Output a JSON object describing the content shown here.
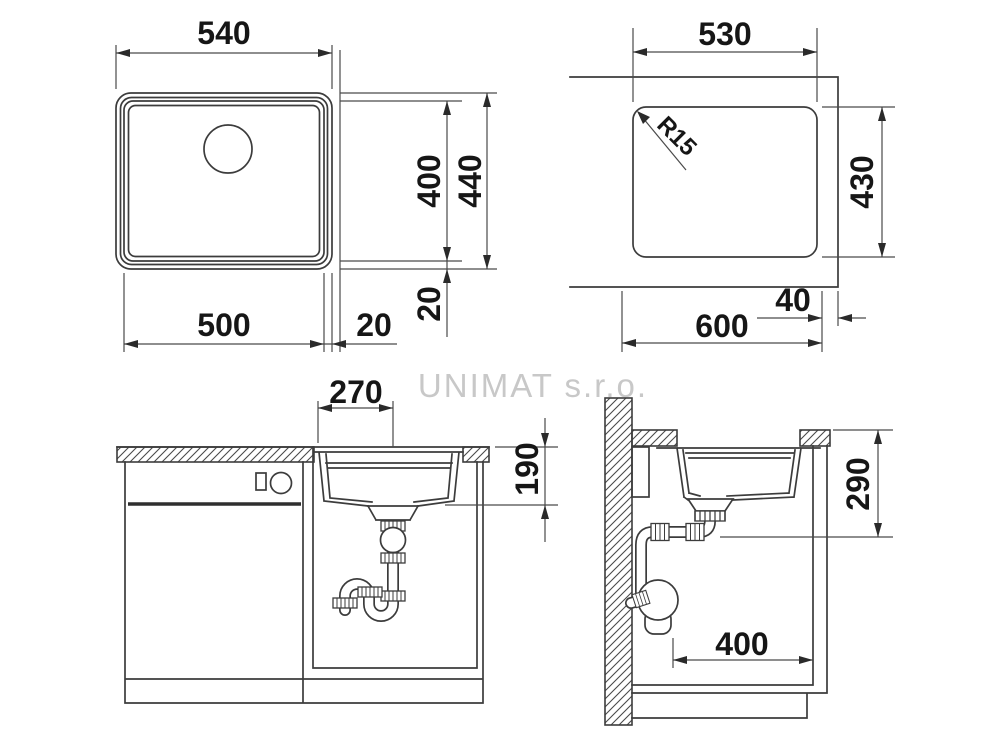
{
  "watermark": "UNIMAT s.r.o.",
  "views": {
    "top_view": {
      "name": "sink plan view",
      "width": "540",
      "bowl_width": "500",
      "bowl_height": "400",
      "height": "440",
      "edge_offset_h": "20",
      "edge_offset_v": "20"
    },
    "cutout_view": {
      "name": "countertop cutout plan",
      "width": "530",
      "height": "430",
      "corner_radius": "R15",
      "cabinet_width": "600",
      "edge_distance": "40"
    },
    "front_view": {
      "name": "front section",
      "drain_offset": "270",
      "bowl_depth": "190"
    },
    "side_view": {
      "name": "side section",
      "outlet_height": "290",
      "drain_wall_distance": "400"
    }
  },
  "colors": {
    "line": "#3c3c3c",
    "text": "#161616",
    "watermark": "#c8c8c8",
    "background": "#ffffff"
  }
}
